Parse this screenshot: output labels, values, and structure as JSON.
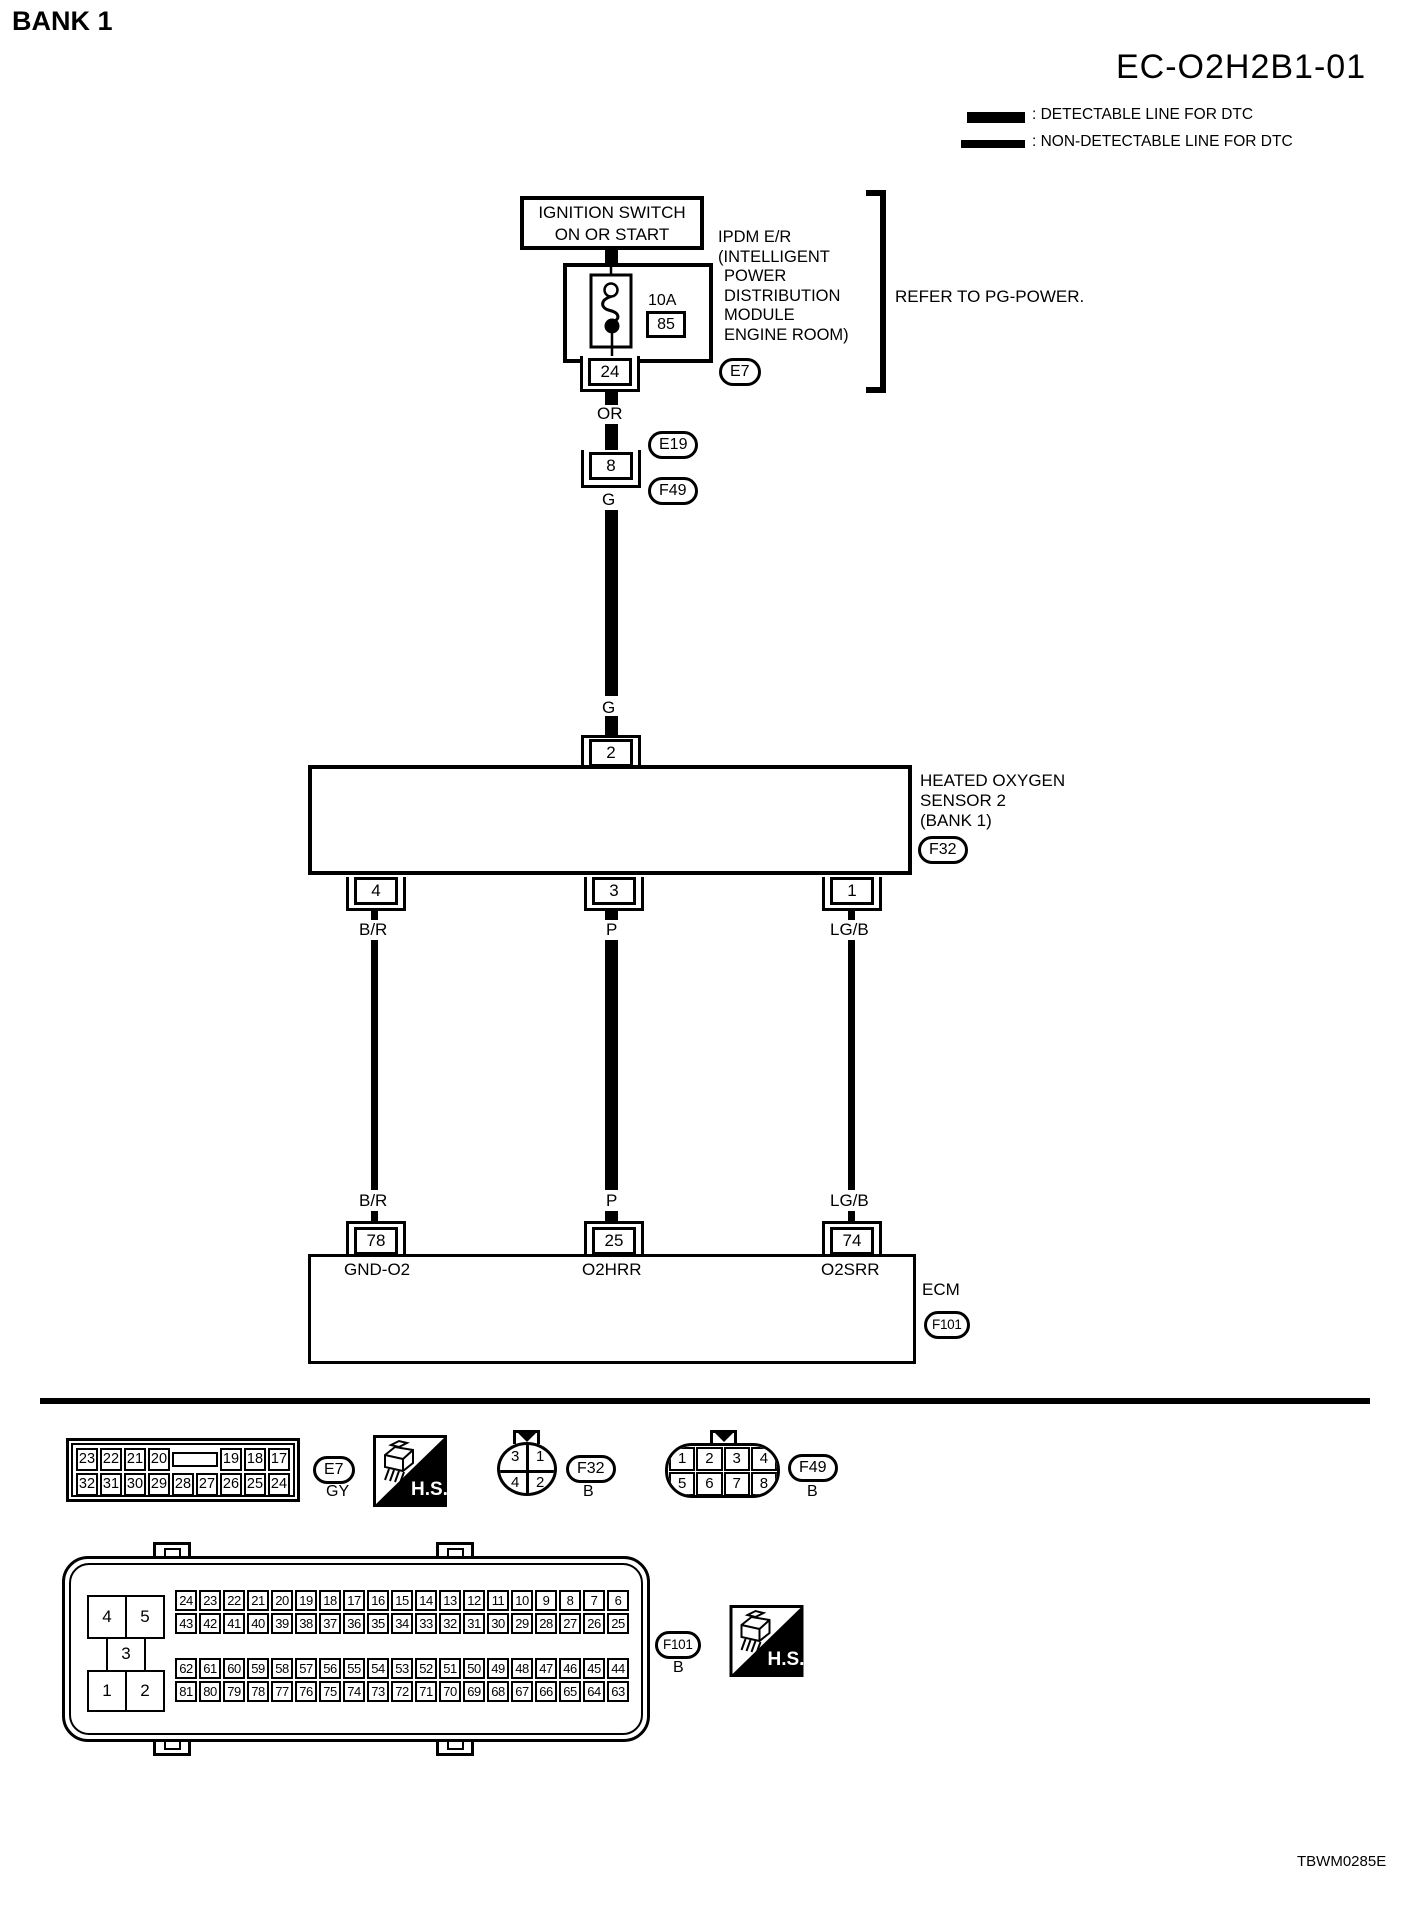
{
  "header": {
    "bank": "BANK 1",
    "code": "EC-O2H2B1-01"
  },
  "legend": {
    "detectable": ": DETECTABLE LINE FOR DTC",
    "non_detectable": ": NON-DETECTABLE LINE FOR DTC"
  },
  "ignition": {
    "line1": "IGNITION SWITCH",
    "line2": "ON OR START"
  },
  "ipdm": {
    "fuse_rating": "10A",
    "fuse_number": "85",
    "pin": "24",
    "connector": "E7",
    "name_lines": [
      "IPDM E/R",
      "(INTELLIGENT",
      "POWER",
      "DISTRIBUTION",
      "MODULE",
      "ENGINE ROOM)"
    ],
    "note": "REFER TO PG-POWER."
  },
  "wires": {
    "or": "OR",
    "g_upper": "G",
    "g_lower": "G",
    "left": "B/R",
    "middle": "P",
    "right": "LG/B"
  },
  "inline_connectors": {
    "pin": "8",
    "upper": "E19",
    "lower": "F49"
  },
  "sensor": {
    "pin_top": "2",
    "pin_left": "4",
    "pin_middle": "3",
    "pin_right": "1",
    "name_lines": [
      "HEATED OXYGEN",
      "SENSOR 2",
      "(BANK 1)"
    ],
    "connector": "F32"
  },
  "ecm": {
    "pin_left": "78",
    "pin_middle": "25",
    "pin_right": "74",
    "signal_left": "GND-O2",
    "signal_middle": "O2HRR",
    "signal_right": "O2SRR",
    "name": "ECM",
    "connector": "F101"
  },
  "views": {
    "hs_label": "H.S.",
    "e7": {
      "row1a": [
        "23",
        "22",
        "21",
        "20"
      ],
      "row1b": [
        "19",
        "18",
        "17"
      ],
      "row2": [
        "32",
        "31",
        "30",
        "29",
        "28",
        "27",
        "26",
        "25",
        "24"
      ],
      "label": "E7",
      "color": "GY"
    },
    "f32": {
      "cells": [
        "3",
        "1",
        "4",
        "2"
      ],
      "label": "F32",
      "color": "B"
    },
    "f49": {
      "row1": [
        "1",
        "2",
        "3",
        "4"
      ],
      "row2": [
        "5",
        "6",
        "7",
        "8"
      ],
      "label": "F49",
      "color": "B"
    },
    "f101": {
      "left_top": [
        "4",
        "5"
      ],
      "left_middle": "3",
      "left_bottom": [
        "1",
        "2"
      ],
      "grid1_row1": [
        "24",
        "23",
        "22",
        "21",
        "20",
        "19",
        "18",
        "17",
        "16",
        "15",
        "14",
        "13",
        "12",
        "11",
        "10",
        "9",
        "8",
        "7",
        "6"
      ],
      "grid1_row2": [
        "43",
        "42",
        "41",
        "40",
        "39",
        "38",
        "37",
        "36",
        "35",
        "34",
        "33",
        "32",
        "31",
        "30",
        "29",
        "28",
        "27",
        "26",
        "25"
      ],
      "grid2_row1": [
        "62",
        "61",
        "60",
        "59",
        "58",
        "57",
        "56",
        "55",
        "54",
        "53",
        "52",
        "51",
        "50",
        "49",
        "48",
        "47",
        "46",
        "45",
        "44"
      ],
      "grid2_row2": [
        "81",
        "80",
        "79",
        "78",
        "77",
        "76",
        "75",
        "74",
        "73",
        "72",
        "71",
        "70",
        "69",
        "68",
        "67",
        "66",
        "65",
        "64",
        "63"
      ],
      "label": "F101",
      "color": "B"
    }
  },
  "footer": {
    "code": "TBWM0285E"
  }
}
